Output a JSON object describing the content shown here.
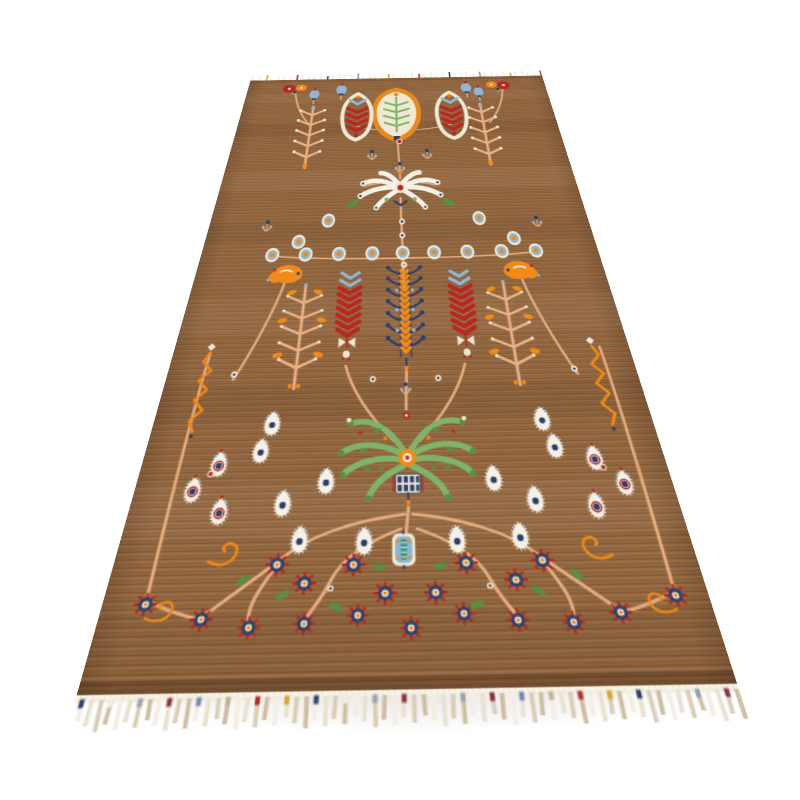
{
  "scene": {
    "alt": "Hand-knotted brown wool runner rug photographed in perspective on a white background, decorated with tribal botanical motifs: red chevron botehs and an orange shield medallion at the top, an ivory spray palmette, rows of blue-and-orange rosettes, three chevron trees (red, blue, red), a large green palmette, white eye-flowers, garlands of navy rosette flowers along the bottom, and a white fringe with small multicolored tassels on both ends.",
    "background": "#ffffff"
  },
  "palette": {
    "field": "#926740",
    "fieldLight": "#a5754a",
    "fieldDark": "#7c5130",
    "vine": "#e9b183",
    "cream": "#f0e8d2",
    "white": "#f6f1e7",
    "red": "#b82723",
    "orange": "#e8891f",
    "orangeB": "#f08a18",
    "navy": "#2e3f6b",
    "blue": "#92b6d2",
    "greenL": "#7fb468",
    "greenD": "#579043",
    "teal": "#3f9490",
    "mustard": "#d9a430",
    "slate": "#8c95a5",
    "maroon": "#8c3040",
    "tan": "#c3b294",
    "selvage": "#f2ecdf",
    "shadow": "#6e5540"
  },
  "motifs": {
    "placements": [
      {
        "m": "shield-medallion",
        "x": 202,
        "y": 100,
        "sx": 1.25,
        "sy": 2.2
      },
      {
        "m": "boteh-red",
        "x": 151,
        "y": 103,
        "sx": 1.25,
        "sy": 2.2
      },
      {
        "m": "boteh-red",
        "x": 273,
        "y": 103,
        "sx": 1.25,
        "sy": 2.2,
        "f": 1
      },
      {
        "m": "tulip-blue",
        "x": 128,
        "y": 38,
        "sx": 1.2,
        "sy": 2.0
      },
      {
        "m": "tulip-blue",
        "x": 297,
        "y": 38,
        "sx": 1.2,
        "sy": 2.0
      },
      {
        "m": "tulip-blue",
        "x": 92,
        "y": 50,
        "sx": 1.1,
        "sy": 1.9
      },
      {
        "m": "tulip-blue",
        "x": 313,
        "y": 50,
        "sx": 1.1,
        "sy": 1.9
      },
      {
        "m": "corner-flower",
        "x": 64,
        "y": 26,
        "sx": 1.25,
        "sy": 2.1
      },
      {
        "m": "corner-flower",
        "x": 341,
        "y": 26,
        "sx": 1.25,
        "sy": 2.1,
        "f": 1
      },
      {
        "m": "branch-top",
        "x": 93,
        "y": 150,
        "sx": 1.2,
        "sy": 2.1
      },
      {
        "m": "branch-top",
        "x": 312,
        "y": 150,
        "sx": 1.2,
        "sy": 2.1,
        "f": 1
      },
      {
        "m": "red-dot",
        "x": 205,
        "y": 168,
        "sx": 1.1,
        "sy": 1.9
      },
      {
        "m": "sprig-blue",
        "x": 172,
        "y": 196,
        "sx": 1.1,
        "sy": 1.9
      },
      {
        "m": "sprig-blue",
        "x": 238,
        "y": 196,
        "sx": 1.1,
        "sy": 1.9
      },
      {
        "m": "sprig-blue",
        "x": 205,
        "y": 224,
        "sx": 1.1,
        "sy": 1.9
      },
      {
        "m": "ivory-spray",
        "x": 205,
        "y": 268,
        "sx": 1.12,
        "sy": 1.9
      },
      {
        "m": "rosette",
        "x": 127,
        "y": 328,
        "sx": 1.0,
        "sy": 1.75
      },
      {
        "m": "rosette",
        "x": 289,
        "y": 328,
        "sx": 1.0,
        "sy": 1.75
      },
      {
        "m": "sprig-blue",
        "x": 62,
        "y": 334,
        "sx": 1.0,
        "sy": 1.7
      },
      {
        "m": "sprig-blue",
        "x": 350,
        "y": 334,
        "sx": 1.0,
        "sy": 1.7
      },
      {
        "m": "rosette",
        "x": 98,
        "y": 364,
        "sx": 1.0,
        "sy": 1.65
      },
      {
        "m": "rosette",
        "x": 322,
        "y": 364,
        "sx": 1.0,
        "sy": 1.65
      },
      {
        "m": "leaf-green",
        "x": 152,
        "y": 298,
        "sx": 1.05,
        "sy": 1.8,
        "r": -25
      },
      {
        "m": "leaf-green",
        "x": 258,
        "y": 298,
        "sx": 1.05,
        "sy": 1.8,
        "r": 25
      },
      {
        "m": "white-dot",
        "x": 206,
        "y": 332,
        "sx": 1.0,
        "sy": 1.7
      },
      {
        "m": "white-dot",
        "x": 206,
        "y": 356,
        "sx": 1.0,
        "sy": 1.65
      },
      {
        "m": "rosette",
        "x": 73,
        "y": 385,
        "sx": 1.0,
        "sy": 1.6
      },
      {
        "m": "rosette",
        "x": 107,
        "y": 385,
        "sx": 1.0,
        "sy": 1.6
      },
      {
        "m": "rosette",
        "x": 141,
        "y": 385,
        "sx": 1.0,
        "sy": 1.6
      },
      {
        "m": "rosette",
        "x": 175,
        "y": 385,
        "sx": 1.0,
        "sy": 1.6
      },
      {
        "m": "rosette",
        "x": 206,
        "y": 385,
        "sx": 1.0,
        "sy": 1.6
      },
      {
        "m": "rosette",
        "x": 238,
        "y": 385,
        "sx": 1.0,
        "sy": 1.6
      },
      {
        "m": "rosette",
        "x": 272,
        "y": 385,
        "sx": 1.0,
        "sy": 1.6
      },
      {
        "m": "rosette",
        "x": 307,
        "y": 385,
        "sx": 1.0,
        "sy": 1.6
      },
      {
        "m": "rosette",
        "x": 342,
        "y": 385,
        "sx": 1.0,
        "sy": 1.6
      },
      {
        "m": "orange-bird",
        "x": 90,
        "y": 415,
        "sx": 1.0,
        "sy": 1.5
      },
      {
        "m": "orange-bird",
        "x": 322,
        "y": 415,
        "sx": 1.0,
        "sy": 1.5,
        "f": 1
      },
      {
        "m": "tree-red",
        "x": 154,
        "y": 470,
        "sx": 0.94,
        "sy": 1.37
      },
      {
        "m": "tree-red",
        "x": 261,
        "y": 470,
        "sx": 0.94,
        "sy": 1.37
      },
      {
        "m": "tree-blue",
        "x": 207,
        "y": 470,
        "sx": 0.94,
        "sy": 1.37
      },
      {
        "m": "branch-mid",
        "x": 111,
        "y": 500,
        "sx": 0.9,
        "sy": 1.3
      },
      {
        "m": "branch-mid",
        "x": 303,
        "y": 500,
        "sx": 0.9,
        "sy": 1.3,
        "f": 1
      },
      {
        "m": "zigzag-orange",
        "x": 33,
        "y": 565,
        "sx": 0.85,
        "sy": 1.1
      },
      {
        "m": "zigzag-orange",
        "x": 372,
        "y": 565,
        "sx": 0.85,
        "sy": 1.1,
        "f": 1
      },
      {
        "m": "white-dot",
        "x": 58,
        "y": 548,
        "sx": 0.85,
        "sy": 1.15
      },
      {
        "m": "white-dot",
        "x": 352,
        "y": 548,
        "sx": 0.85,
        "sy": 1.15
      },
      {
        "m": "sprig-blue",
        "x": 206,
        "y": 566,
        "sx": 0.85,
        "sy": 1.15
      },
      {
        "m": "white-dot",
        "x": 178,
        "y": 556,
        "sx": 0.82,
        "sy": 1.1
      },
      {
        "m": "white-dot",
        "x": 234,
        "y": 556,
        "sx": 0.82,
        "sy": 1.1
      },
      {
        "m": "green-palmette",
        "x": 206,
        "y": 638,
        "sx": 0.78,
        "sy": 0.95
      },
      {
        "m": "eye-flower",
        "x": 97,
        "y": 601,
        "sx": 0.78,
        "sy": 0.95
      },
      {
        "m": "eye-flower",
        "x": 316,
        "y": 601,
        "sx": 0.78,
        "sy": 0.95,
        "f": 1
      },
      {
        "m": "eye-flower",
        "x": 91,
        "y": 628,
        "sx": 0.76,
        "sy": 0.92
      },
      {
        "m": "eye-flower",
        "x": 322,
        "y": 628,
        "sx": 0.76,
        "sy": 0.92,
        "f": 1
      },
      {
        "m": "eye-flower-red",
        "x": 60,
        "y": 640,
        "sx": 0.75,
        "sy": 0.9
      },
      {
        "m": "eye-flower-red",
        "x": 351,
        "y": 640,
        "sx": 0.75,
        "sy": 0.9,
        "f": 1
      },
      {
        "m": "eye-flower",
        "x": 144,
        "y": 657,
        "sx": 0.75,
        "sy": 0.9
      },
      {
        "m": "eye-flower",
        "x": 271,
        "y": 657,
        "sx": 0.75,
        "sy": 0.9,
        "f": 1
      },
      {
        "m": "eye-flower",
        "x": 113,
        "y": 676,
        "sx": 0.74,
        "sy": 0.88
      },
      {
        "m": "eye-flower",
        "x": 300,
        "y": 676,
        "sx": 0.74,
        "sy": 0.88,
        "f": 1
      },
      {
        "m": "eye-flower-red",
        "x": 67,
        "y": 682,
        "sx": 0.73,
        "sy": 0.87
      },
      {
        "m": "eye-flower-red",
        "x": 344,
        "y": 682,
        "sx": 0.73,
        "sy": 0.87,
        "f": 1
      },
      {
        "m": "eye-flower",
        "x": 128,
        "y": 706,
        "sx": 0.72,
        "sy": 0.85
      },
      {
        "m": "eye-flower",
        "x": 285,
        "y": 706,
        "sx": 0.72,
        "sy": 0.85,
        "f": 1
      },
      {
        "m": "eye-flower",
        "x": 174,
        "y": 708,
        "sx": 0.72,
        "sy": 0.85
      },
      {
        "m": "eye-flower",
        "x": 240,
        "y": 708,
        "sx": 0.72,
        "sy": 0.85,
        "f": 1
      },
      {
        "m": "eye-flower-red",
        "x": 44,
        "y": 663,
        "sx": 0.73,
        "sy": 0.87
      },
      {
        "m": "eye-flower-red",
        "x": 369,
        "y": 663,
        "sx": 0.73,
        "sy": 0.87,
        "f": 1
      },
      {
        "m": "red-dot",
        "x": 55,
        "y": 650,
        "sx": 0.75,
        "sy": 0.9
      },
      {
        "m": "red-dot",
        "x": 356,
        "y": 650,
        "sx": 0.75,
        "sy": 0.9
      },
      {
        "m": "tendril",
        "x": 76,
        "y": 716,
        "sx": 0.75,
        "sy": 0.85
      },
      {
        "m": "tendril",
        "x": 337,
        "y": 716,
        "sx": 0.75,
        "sy": 0.85,
        "f": 1
      },
      {
        "m": "blue-medallion",
        "x": 202,
        "y": 716,
        "sx": 0.68,
        "sy": 0.73
      },
      {
        "m": "navy-flower",
        "x": 114,
        "y": 726,
        "sx": 0.7,
        "sy": 0.74
      },
      {
        "m": "navy-flower",
        "x": 298,
        "y": 726,
        "sx": 0.7,
        "sy": 0.74
      },
      {
        "m": "navy-flower",
        "x": 134,
        "y": 740,
        "sx": 0.69,
        "sy": 0.72
      },
      {
        "m": "navy-flower",
        "x": 278,
        "y": 740,
        "sx": 0.69,
        "sy": 0.72
      },
      {
        "m": "navy-flower",
        "x": 167,
        "y": 727,
        "sx": 0.7,
        "sy": 0.74
      },
      {
        "m": "navy-flower",
        "x": 245,
        "y": 727,
        "sx": 0.7,
        "sy": 0.74
      },
      {
        "m": "navy-flower",
        "x": 189,
        "y": 748,
        "sx": 0.68,
        "sy": 0.71
      },
      {
        "m": "navy-flower",
        "x": 223,
        "y": 748,
        "sx": 0.68,
        "sy": 0.71
      },
      {
        "m": "navy-flower",
        "x": 29,
        "y": 753,
        "sx": 0.67,
        "sy": 0.7
      },
      {
        "m": "navy-flower",
        "x": 383,
        "y": 753,
        "sx": 0.67,
        "sy": 0.7
      },
      {
        "m": "navy-flower",
        "x": 68,
        "y": 764,
        "sx": 0.66,
        "sy": 0.68
      },
      {
        "m": "navy-flower",
        "x": 344,
        "y": 764,
        "sx": 0.66,
        "sy": 0.68
      },
      {
        "m": "navy-flower",
        "x": 100,
        "y": 770,
        "sx": 0.65,
        "sy": 0.67
      },
      {
        "m": "navy-flower",
        "x": 312,
        "y": 770,
        "sx": 0.65,
        "sy": 0.67
      },
      {
        "m": "navy-flower",
        "x": 136,
        "y": 768,
        "sx": 0.65,
        "sy": 0.67
      },
      {
        "m": "navy-flower",
        "x": 276,
        "y": 768,
        "sx": 0.65,
        "sy": 0.67
      },
      {
        "m": "navy-flower",
        "x": 171,
        "y": 763,
        "sx": 0.65,
        "sy": 0.67
      },
      {
        "m": "navy-flower",
        "x": 241,
        "y": 763,
        "sx": 0.65,
        "sy": 0.67
      },
      {
        "m": "navy-flower",
        "x": 206,
        "y": 772,
        "sx": 0.65,
        "sy": 0.67
      },
      {
        "m": "leaf-green",
        "x": 120,
        "y": 748,
        "sx": 0.7,
        "sy": 0.72,
        "r": -30
      },
      {
        "m": "leaf-green",
        "x": 292,
        "y": 748,
        "sx": 0.7,
        "sy": 0.72,
        "r": 30
      },
      {
        "m": "leaf-green",
        "x": 156,
        "y": 757,
        "sx": 0.7,
        "sy": 0.72,
        "r": 20
      },
      {
        "m": "leaf-green",
        "x": 250,
        "y": 757,
        "sx": 0.7,
        "sy": 0.72,
        "r": -20
      },
      {
        "m": "leaf-green",
        "x": 92,
        "y": 737,
        "sx": 0.7,
        "sy": 0.72,
        "r": -45
      },
      {
        "m": "leaf-green",
        "x": 320,
        "y": 737,
        "sx": 0.7,
        "sy": 0.72,
        "r": 45
      },
      {
        "m": "leaf-green",
        "x": 185,
        "y": 729,
        "sx": 0.68,
        "sy": 0.7,
        "r": 10
      },
      {
        "m": "leaf-green",
        "x": 227,
        "y": 729,
        "sx": 0.68,
        "sy": 0.7,
        "r": -10
      },
      {
        "m": "tendril",
        "x": 40,
        "y": 757,
        "sx": 0.66,
        "sy": 0.68
      },
      {
        "m": "tendril",
        "x": 372,
        "y": 757,
        "sx": 0.66,
        "sy": 0.68,
        "f": 1
      },
      {
        "m": "white-dot",
        "x": 152,
        "y": 744,
        "sx": 0.68,
        "sy": 0.7
      },
      {
        "m": "white-dot",
        "x": 260,
        "y": 744,
        "sx": 0.68,
        "sy": 0.7
      }
    ]
  },
  "fringe": {
    "top": {
      "count": 48,
      "tick_colors": [
        "#f3eee3",
        "#2e3f6b",
        "#b52b2b",
        "#d9a430",
        "#8c95a5"
      ]
    },
    "bottom": {
      "count": 68,
      "strand_shades": [
        "#f3eee3",
        "#e9e1d0",
        "#d9cdb6",
        "#cdbda1"
      ],
      "bar_colors": [
        "#2e3f6b",
        "#d9a430",
        "#b52b2b",
        "#c3b294",
        "#7487b5",
        "#8c3040",
        "#9aa2ad",
        "#f3eee3"
      ]
    }
  }
}
